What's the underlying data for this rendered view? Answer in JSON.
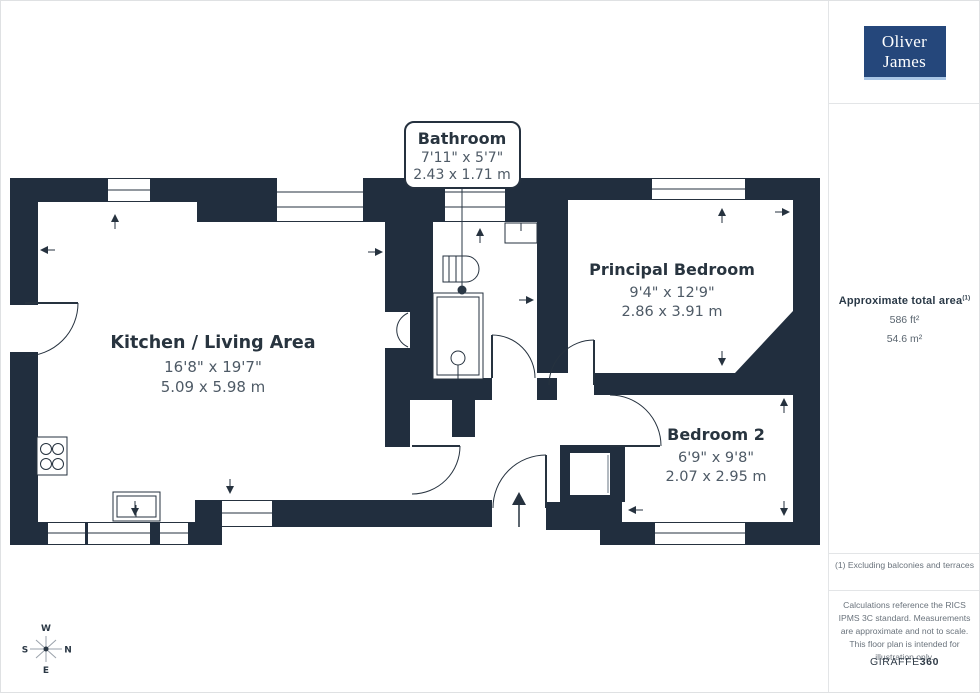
{
  "branding": {
    "logo_line1": "Oliver",
    "logo_line2": "James"
  },
  "sidebar": {
    "area_title": "Approximate total area",
    "area_note_ref": "(1)",
    "area_imperial": "586 ft²",
    "area_metric": "54.6 m²",
    "footnote": "(1) Excluding balconies and terraces",
    "disclaimer": "Calculations reference the RICS IPMS 3C standard. Measurements are approximate and not to scale. This floor plan is intended for illustration only.",
    "credit_normal": "GIRAFFE",
    "credit_bold": "360"
  },
  "rooms": [
    {
      "id": "kitchen-living",
      "name": "Kitchen / Living Area",
      "imperial": "16'8\" x 19'7\"",
      "metric": "5.09 x 5.98 m"
    },
    {
      "id": "bathroom",
      "name": "Bathroom",
      "imperial": "7'11\" x 5'7\"",
      "metric": "2.43 x 1.71 m"
    },
    {
      "id": "principal-bedroom",
      "name": "Principal Bedroom",
      "imperial": "9'4\" x 12'9\"",
      "metric": "2.86 x 3.91 m"
    },
    {
      "id": "bedroom-2",
      "name": "Bedroom 2",
      "imperial": "6'9\" x 9'8\"",
      "metric": "2.07 x 2.95 m"
    }
  ],
  "compass": {
    "top": "W",
    "right": "N",
    "bottom": "E",
    "left": "S"
  },
  "colors": {
    "wall": "#212e3e",
    "logo_bg": "#25477b",
    "logo_underline": "#a9c6e6",
    "accent_text": "#28343f"
  }
}
